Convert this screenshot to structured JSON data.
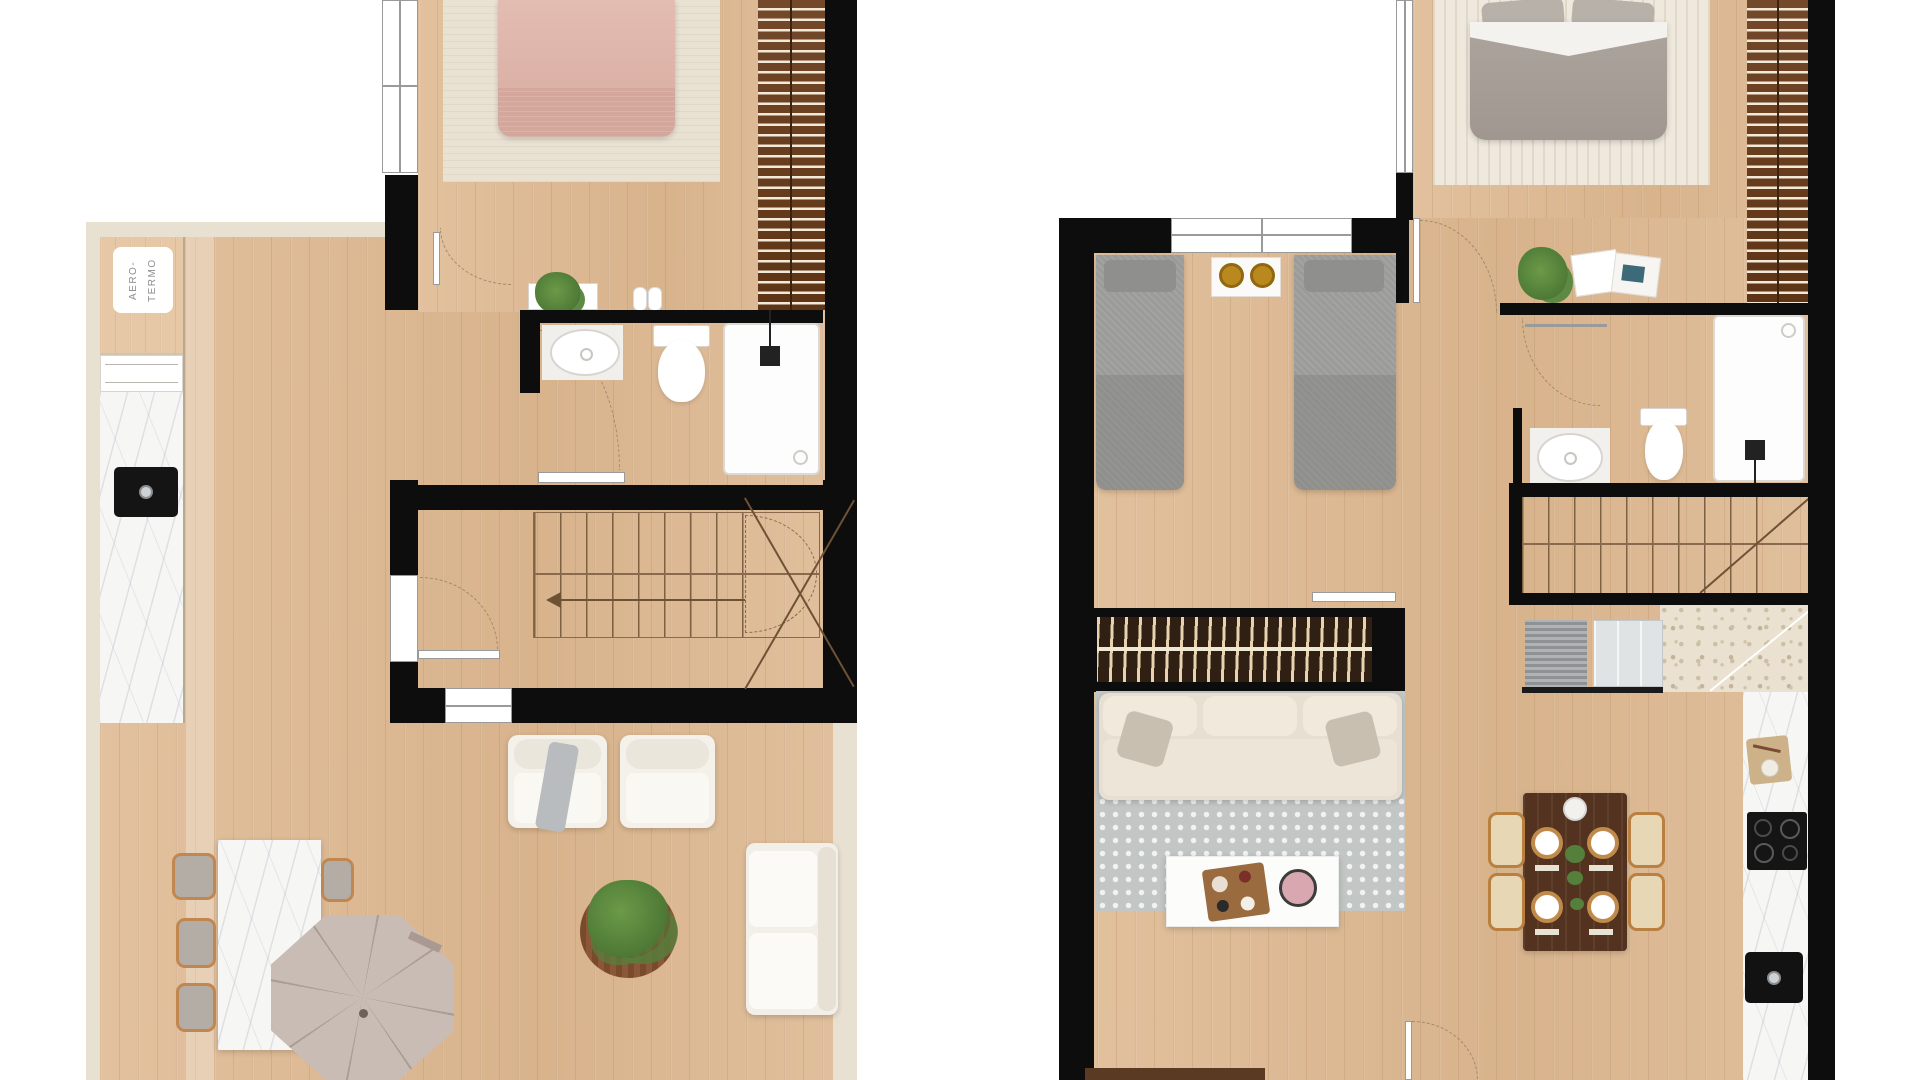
{
  "image": {
    "description": "Top-down architectural render of two apartment floor plans side by side",
    "width": 1920,
    "height": 1080
  },
  "palette": {
    "wall": "#0d0d0d",
    "floor_wood": "#dcba94",
    "border_beige": "#e8e0d1",
    "marble": "#f6f6f5",
    "terrazzo": "#eae1d0",
    "wardrobe_brown": "#6d431f",
    "slat_cream": "#f3e9d8",
    "bed_pink": "#ddb3a9",
    "bed_gray": "#a7a099",
    "twin_bed_gray": "#9b9b99",
    "rug_beige": "#e9e2d3",
    "rug_gray": "#c2c6c5",
    "sofa_cream": "#ece5d8",
    "table_dark_wood": "#53331f",
    "gold": "#b9891f",
    "plant_green": "#55803c",
    "umbrella_taupe": "#c9bcb5"
  },
  "plan_left": {
    "name": "unit-1-floorplan",
    "kitchen": {
      "aerotermo_label": "AERO-\nTERMO"
    },
    "rooms": [
      "bedroom",
      "bathroom",
      "staircase-hall",
      "living-dining-kitchen"
    ],
    "furniture": [
      "double-bed",
      "area-rug",
      "slatted-wardrobe",
      "window",
      "dresser",
      "potted-plant",
      "towels",
      "washbasin",
      "toilet",
      "shower",
      "sliding-door",
      "staircase",
      "entry-door",
      "window",
      "kitchen-counter",
      "aerothermal-unit",
      "kitchen-sink",
      "marble-dining-table",
      "dining-chair",
      "dining-chair",
      "dining-chair",
      "dining-chair",
      "parasol",
      "armchair",
      "armchair",
      "floor-plant",
      "sofa"
    ]
  },
  "plan_right": {
    "name": "unit-2-floorplan",
    "rooms": [
      "master-bedroom",
      "twin-bedroom",
      "bathroom",
      "staircase-entry",
      "living-dining-kitchen"
    ],
    "furniture": [
      "double-bed",
      "area-rug",
      "slatted-wardrobe",
      "window",
      "twin-bed",
      "twin-bed",
      "nightstand",
      "gold-trays",
      "potted-plant",
      "magazines",
      "towel-rail",
      "washbasin",
      "toilet",
      "shower",
      "staircase",
      "doormat",
      "glass-partition",
      "slatted-partition",
      "sliding-door",
      "sofa",
      "dotted-rug",
      "coffee-table",
      "serving-tray",
      "sideboard",
      "dining-table",
      "dining-chair",
      "dining-chair",
      "dining-chair",
      "dining-chair",
      "kitchen-counter",
      "cutting-board",
      "cooktop",
      "kitchen-sink",
      "interior-door"
    ]
  }
}
